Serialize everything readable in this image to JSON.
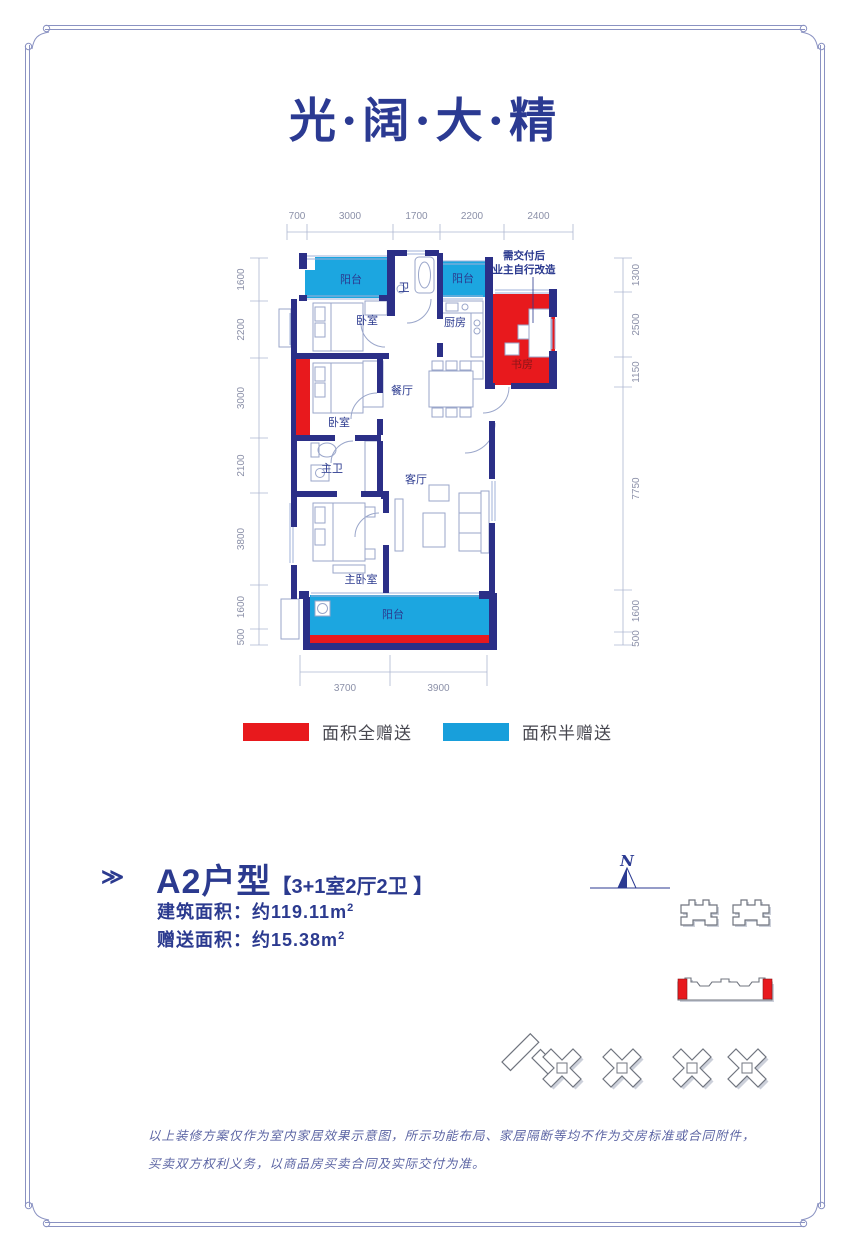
{
  "page": {
    "title": "光·阔·大·精"
  },
  "colors": {
    "title_navy": "#2b3a92",
    "wall_navy": "#2b2f87",
    "gift_full_red": "#e8191d",
    "gift_half_blue": "#189fdb",
    "plan_line": "#9aa6ca",
    "dim_text": "#8b90a8",
    "frame_line": "#8a92c2",
    "study_label_red": "#8a1518"
  },
  "floor_plan": {
    "annotation": [
      "需交付后",
      "业主自行改造"
    ],
    "rooms": [
      {
        "name": "阳台",
        "x": 136,
        "y": 88
      },
      {
        "name": "卫",
        "x": 189,
        "y": 96
      },
      {
        "name": "阳台",
        "x": 248,
        "y": 87
      },
      {
        "name": "卧室",
        "x": 152,
        "y": 129
      },
      {
        "name": "厨房",
        "x": 240,
        "y": 131
      },
      {
        "name": "书房",
        "x": 307,
        "y": 173,
        "color": "study"
      },
      {
        "name": "餐厅",
        "x": 187,
        "y": 199
      },
      {
        "name": "卧室",
        "x": 124,
        "y": 231
      },
      {
        "name": "主卫",
        "x": 117,
        "y": 277
      },
      {
        "name": "客厅",
        "x": 201,
        "y": 288
      },
      {
        "name": "主卧室",
        "x": 146,
        "y": 388
      },
      {
        "name": "阳台",
        "x": 178,
        "y": 423
      }
    ],
    "dims": {
      "top": [
        "700",
        "3000",
        "1700",
        "2200",
        "2400"
      ],
      "left": [
        "1600",
        "2200",
        "3000",
        "2100",
        "3800",
        "1600",
        "500"
      ],
      "right": [
        "1300",
        "2500",
        "1150",
        "7750",
        "1600",
        "500"
      ],
      "bottom": [
        "3700",
        "3900"
      ]
    }
  },
  "legend": {
    "items": [
      {
        "label": "面积全赠送",
        "color": "#e8191d"
      },
      {
        "label": "面积半赠送",
        "color": "#189fdb"
      }
    ]
  },
  "unit": {
    "marker": "≫",
    "name": "A2户型",
    "spec": "【3+1室2厅2卫 】",
    "rows": [
      {
        "label": "建筑面积：",
        "value": "约119.11m",
        "sup": "2"
      },
      {
        "label": "赠送面积：",
        "value": "约15.38m",
        "sup": "2"
      }
    ]
  },
  "site_plan": {
    "compass": "N"
  },
  "disclaimer": [
    "以上装修方案仅作为室内家居效果示意图，所示功能布局、家居隔断等均不作为交房标准或合同附件，",
    "买卖双方权利义务，以商品房买卖合同及实际交付为准。"
  ]
}
